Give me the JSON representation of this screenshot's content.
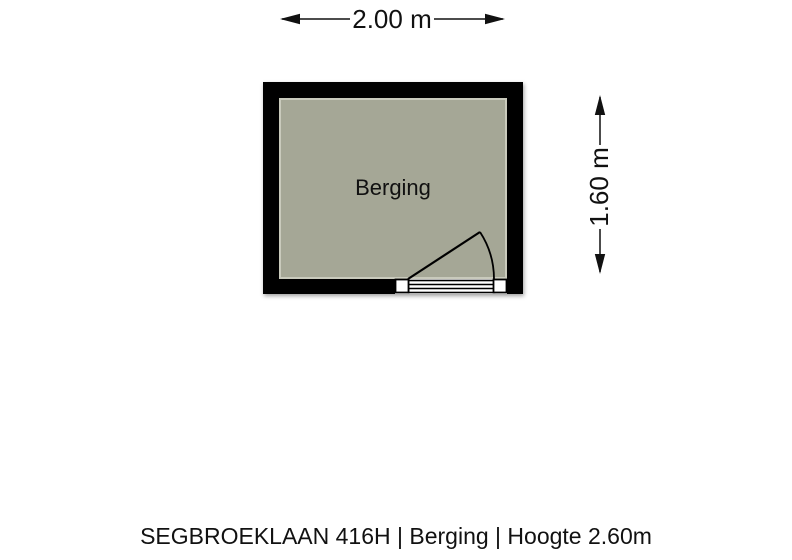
{
  "floorplan": {
    "room": {
      "label": "Berging"
    },
    "dimensions": {
      "width_label": "2.00 m",
      "height_label": "1.60 m"
    },
    "caption": "SEGBROEKLAAN 416H | Berging | Hoogte 2.60m",
    "colors": {
      "wall": "#000000",
      "floor": "#a5a796",
      "floor_edge": "#c9cabc",
      "line": "#111111",
      "background": "#ffffff"
    }
  }
}
